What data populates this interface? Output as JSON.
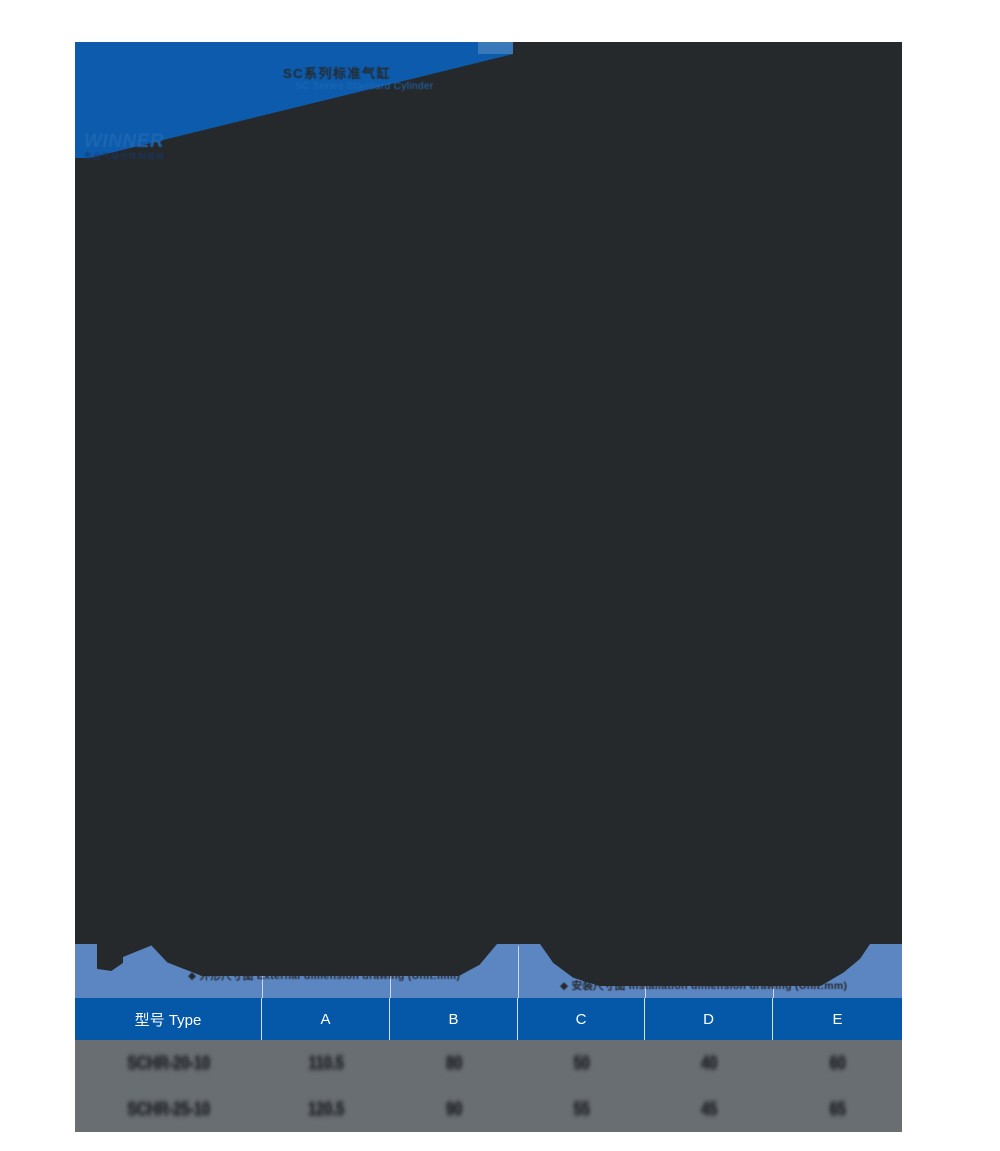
{
  "colors": {
    "banner_blue": "#0d5bac",
    "banner_notch_blue": "#3a79b9",
    "drawing_dark": "#26292c",
    "dimension_band_blue": "#5c86c1",
    "table_header_blue": "#0557a8",
    "table_body_gray": "#696e73",
    "table_text_dark": "#2b2e31",
    "page_background": "#ffffff"
  },
  "banner": {
    "title": "SC系列标准气缸",
    "subtitle": "SC Series Standard Cylinder",
    "logo": "WINNER",
    "tagline": "专业气动元件制造商"
  },
  "drawings": {
    "left_caption": "◆ 外形尺寸图 External dimension drawing (Unit:mm)",
    "right_caption": "◆ 安装尺寸图 Installation dimension drawing (Unit:mm)"
  },
  "table": {
    "headers": [
      "型号 Type",
      "A",
      "B",
      "C",
      "D",
      "E"
    ],
    "rows": [
      [
        "SCHR-20-10",
        "110.5",
        "80",
        "50",
        "40",
        "60"
      ],
      [
        "SCHR-25-10",
        "120.5",
        "90",
        "55",
        "45",
        "65"
      ]
    ]
  }
}
